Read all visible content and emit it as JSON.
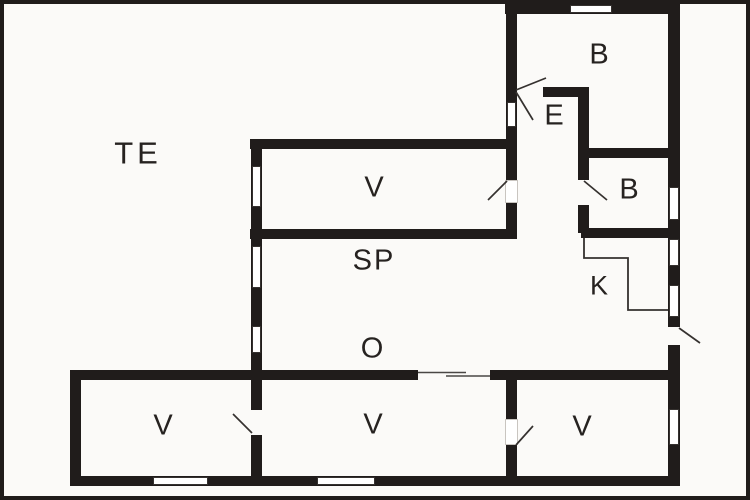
{
  "floor_plan": {
    "colors": {
      "wall": "#201c1b",
      "background": "#fbfaf8",
      "label": "#262220"
    },
    "rooms": [
      {
        "id": "terrace",
        "label": "TE"
      },
      {
        "id": "room-upper",
        "label": "V"
      },
      {
        "id": "living-area",
        "label": "SP"
      },
      {
        "id": "hall",
        "label": "O"
      },
      {
        "id": "entry",
        "label": "E"
      },
      {
        "id": "bath-top",
        "label": "B"
      },
      {
        "id": "bath-middle",
        "label": "B"
      },
      {
        "id": "kitchen",
        "label": "K"
      },
      {
        "id": "room-bottom-left",
        "label": "V"
      },
      {
        "id": "room-bottom-middle",
        "label": "V"
      },
      {
        "id": "room-bottom-right",
        "label": "V"
      }
    ]
  }
}
